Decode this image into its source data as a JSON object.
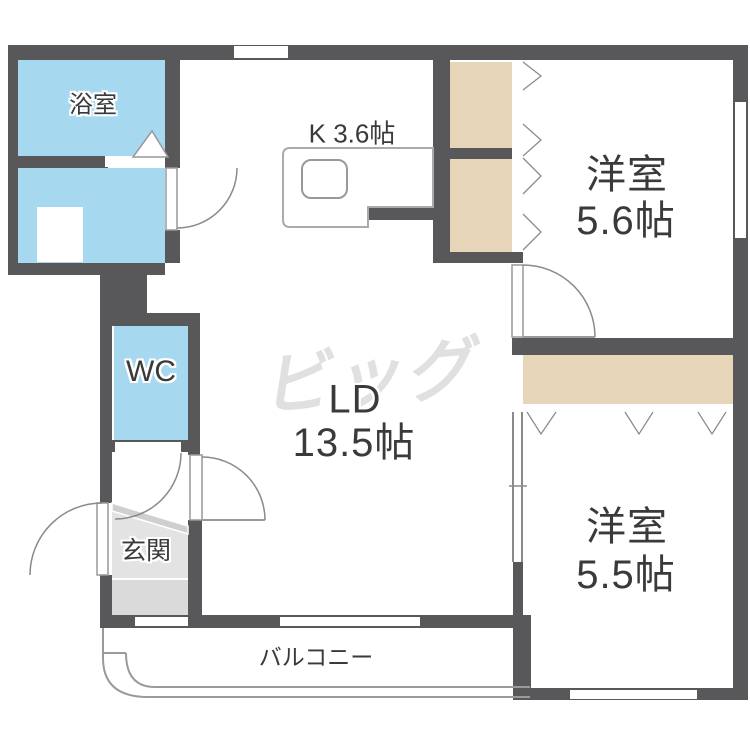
{
  "page": {
    "type": "japanese-apartment-floor-plan"
  },
  "colors": {
    "wall": "#58585a",
    "water": "#a6d8f0",
    "closet": "#e7d5ba",
    "genkan_floor": "#e3e3e3",
    "genkan_step": "#cfcfcf",
    "genkan_lower": "#dadada",
    "line": "#999999",
    "counter_line": "#aaaaaa",
    "text": "#3a3a3a",
    "watermark": "#e0e0e0"
  },
  "rooms": {
    "bathroom": {
      "label": "浴室"
    },
    "kitchen": {
      "label": "K 3.6帖"
    },
    "western_room_1": {
      "name": "洋室",
      "size": "5.6帖"
    },
    "living_dining": {
      "name": "LD",
      "size": "13.5帖"
    },
    "wc": {
      "label": "WC"
    },
    "genkan": {
      "label": "玄関"
    },
    "western_room_2": {
      "name": "洋室",
      "size": "5.5帖"
    },
    "balcony": {
      "label": "バルコニー"
    }
  },
  "watermark": {
    "text": "ビッグ"
  }
}
